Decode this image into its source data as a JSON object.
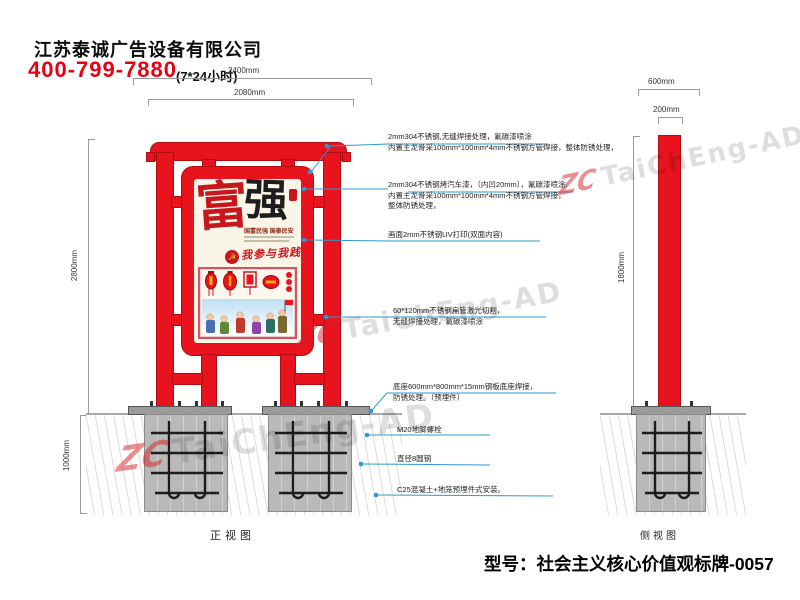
{
  "header": {
    "company": "江苏泰诚广告设备有限公司",
    "phone": "400-799-7880",
    "hours": "(7*24小时)"
  },
  "dims": {
    "top_outer": "2400mm",
    "top_frame": "2080mm",
    "front_height": "2800mm",
    "foundation_depth": "1000mm",
    "side_top": "600mm",
    "side_column": "200mm",
    "side_height": "1800mm"
  },
  "views": {
    "front": "正视图",
    "side": "侧视图"
  },
  "annotations": [
    {
      "lines": [
        "2mm304不锈钢,无缝焊接处理，氟碳漆喷涂",
        "内置主龙骨采100mm*100mm*4mm不锈钢方管焊接，整体防锈处理，"
      ]
    },
    {
      "lines": [
        "2mm304不锈钢烤汽车漆，（内凹20mm），氟碳漆喷涂.",
        "内置主龙骨采100mm*100mm*4mm不锈钢方管焊接，",
        "整体防锈处理，"
      ]
    },
    {
      "lines": [
        "画面2mm不锈钢UV打印(双面内容)"
      ]
    },
    {
      "lines": [
        "60*120mm不锈钢扁管激光切割，",
        "无缝焊接处理，氟碳漆喷涂"
      ]
    },
    {
      "lines": [
        "底座600mm*800mm*15mm钢板底座焊接，",
        "防锈处理。（预埋件）"
      ]
    },
    {
      "lines": [
        "M20地脚螺栓"
      ]
    },
    {
      "lines": [
        "直径8圆钢"
      ]
    },
    {
      "lines": [
        "C25混凝土+地笼预埋件式安装。"
      ]
    }
  ],
  "poster": {
    "char_left": "富",
    "char_right": "强",
    "slogan": "国富民强 国泰民安",
    "motto": "我参与我践行",
    "emblem": "☭"
  },
  "model": {
    "label": "型号：社会主义核心价值观标牌-0057"
  },
  "watermark": {
    "logo": "ZC",
    "text": "TaiChEng-AD"
  },
  "colors": {
    "red": "#e8131d",
    "leader_blue": "#2f9ad0",
    "concrete": "#b9b9b9"
  }
}
